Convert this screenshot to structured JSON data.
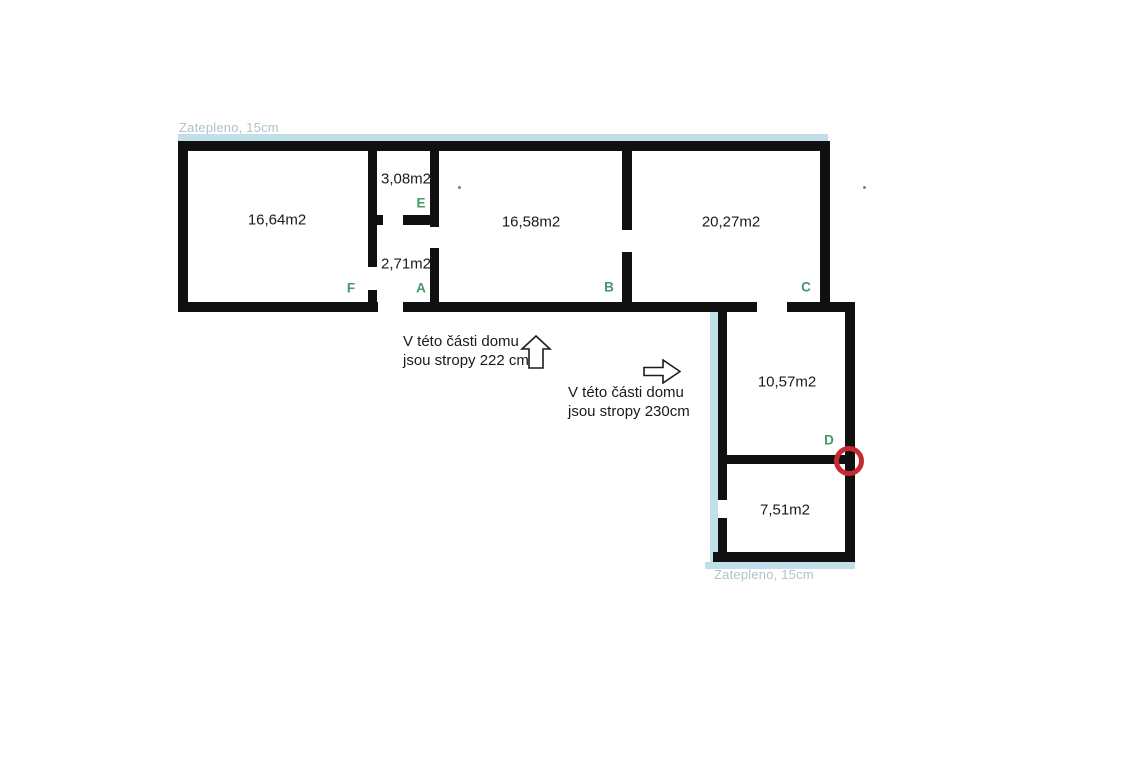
{
  "insulation": {
    "top_label": "Zatepleno, 15cm",
    "bottom_label": "Zatepleno, 15cm"
  },
  "rooms": [
    {
      "name": "room-16-64",
      "area": "16,64m2"
    },
    {
      "name": "room-3-08",
      "area": "3,08m2"
    },
    {
      "name": "room-2-71",
      "area": "2,71m2"
    },
    {
      "name": "room-16-58",
      "area": "16,58m2"
    },
    {
      "name": "room-20-27",
      "area": "20,27m2"
    },
    {
      "name": "room-10-57",
      "area": "10,57m2"
    },
    {
      "name": "room-7-51",
      "area": "7,51m2"
    }
  ],
  "doors": [
    {
      "letter": "E"
    },
    {
      "letter": "F"
    },
    {
      "letter": "A"
    },
    {
      "letter": "B"
    },
    {
      "letter": "C"
    },
    {
      "letter": "D"
    }
  ],
  "notes": [
    {
      "line1": "V této části domu",
      "line2": "jsou stropy 222 cm",
      "arrow": "up-arrow"
    },
    {
      "line1": "V této části domu",
      "line2": "jsou stropy 230cm",
      "arrow": "right-arrow"
    }
  ],
  "colors": {
    "wall": "#101010",
    "letter_green": "#449a66",
    "ins_bar": "#c2dee9",
    "ins_text": "#aec3cc",
    "marker_red": "#c42b30"
  }
}
